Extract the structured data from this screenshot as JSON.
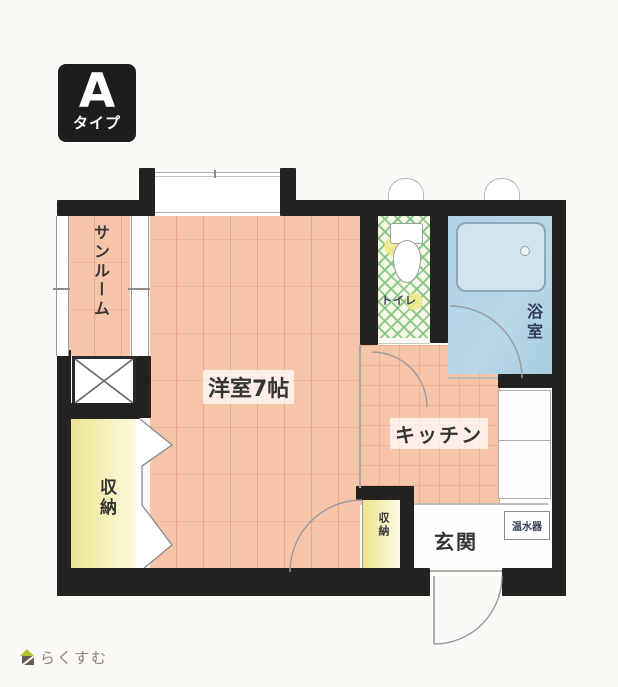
{
  "type_badge": {
    "letter": "A",
    "label": "タイプ",
    "bg": "#1d1d1d",
    "fg": "#ffffff"
  },
  "rooms": {
    "sunroom": {
      "label": "サンルーム"
    },
    "western_room": {
      "label": "洋室7帖"
    },
    "toilet": {
      "label": "トイレ"
    },
    "bath": {
      "label": "浴室"
    },
    "kitchen": {
      "label": "キッチン"
    },
    "storage": {
      "label": "収納"
    },
    "small_storage": {
      "label": "収納"
    },
    "entrance": {
      "label": "玄関"
    },
    "water_heater": {
      "label": "温水器"
    }
  },
  "footer_logo": {
    "text": "らくすむ"
  },
  "colors": {
    "wall": "#242220",
    "floor_pink": "#f7c6aa",
    "floor_yellow": "#ece48f",
    "floor_blue": "#aed2e4",
    "lattice_green": "#7ec17e",
    "badge_bg": "#1d1d1d",
    "logo_green": "#b1c52f",
    "logo_brown": "#6b5c50",
    "label_navy": "#333c55"
  }
}
